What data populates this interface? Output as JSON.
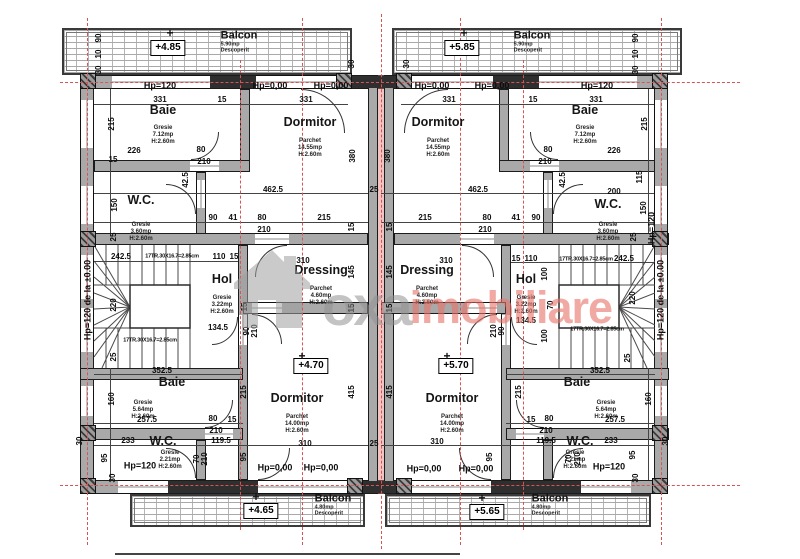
{
  "watermark": {
    "brand": "oxa",
    "suffix": "imobiliare"
  },
  "rooms": [
    {
      "id": "baie-top-left",
      "name": "Baie",
      "m": "Gresie",
      "a": "7.12mp",
      "h": "H:2.60m",
      "nx": 163,
      "ny": 110,
      "sx": 163,
      "sy": 125
    },
    {
      "id": "dormitor-top-left",
      "name": "Dormitor",
      "m": "Parchet",
      "a": "14.55mp",
      "h": "H:2.60m",
      "nx": 310,
      "ny": 122,
      "sx": 310,
      "sy": 138
    },
    {
      "id": "wc-top-left",
      "name": "W.C.",
      "m": "Gresie",
      "a": "3.60mp",
      "h": "H:2.60m",
      "nx": 141,
      "ny": 200,
      "sx": 141,
      "sy": 222
    },
    {
      "id": "hol-left",
      "name": "Hol",
      "m": "Gresie",
      "a": "3.22mp",
      "h": "H:2.60m",
      "nx": 222,
      "ny": 279,
      "sx": 222,
      "sy": 295
    },
    {
      "id": "dressing-left",
      "name": "Dressing",
      "m": "Parchet",
      "a": "4.60mp",
      "h": "H:2.60m",
      "nx": 321,
      "ny": 270,
      "sx": 321,
      "sy": 286
    },
    {
      "id": "dormitor-bottom-left",
      "name": "Dormitor",
      "m": "Parchet",
      "a": "14.00mp",
      "h": "H:2.60m",
      "nx": 297,
      "ny": 398,
      "sx": 297,
      "sy": 414
    },
    {
      "id": "baie-bottom-left",
      "name": "Baie",
      "m": "Gresie",
      "a": "5.64mp",
      "h": "H:2.60m",
      "nx": 172,
      "ny": 382,
      "sx": 143,
      "sy": 400
    },
    {
      "id": "wc-bottom-left",
      "name": "W.C.",
      "m": "Gresie",
      "a": "2.21mp",
      "h": "H:2.60m",
      "nx": 163,
      "ny": 441,
      "sx": 170,
      "sy": 450
    },
    {
      "id": "dormitor-top-right",
      "name": "Dormitor",
      "m": "Parchet",
      "a": "14.55mp",
      "h": "H:2.60m",
      "nx": 438,
      "ny": 122,
      "sx": 438,
      "sy": 138
    },
    {
      "id": "baie-top-right",
      "name": "Baie",
      "m": "Gresie",
      "a": "7.12mp",
      "h": "H:2.60m",
      "nx": 585,
      "ny": 110,
      "sx": 585,
      "sy": 125
    },
    {
      "id": "wc-top-right",
      "name": "W.C.",
      "m": "Gresie",
      "a": "3.60mp",
      "h": "H:2.60m",
      "nx": 608,
      "ny": 204,
      "sx": 608,
      "sy": 222
    },
    {
      "id": "hol-right",
      "name": "Hol",
      "m": "Gresie",
      "a": "3.22mp",
      "h": "H:2.60m",
      "nx": 526,
      "ny": 279,
      "sx": 526,
      "sy": 295
    },
    {
      "id": "dressing-right",
      "name": "Dressing",
      "m": "Parchet",
      "a": "4.60mp",
      "h": "H:2.60m",
      "nx": 427,
      "ny": 270,
      "sx": 427,
      "sy": 286
    },
    {
      "id": "dormitor-bottom-right",
      "name": "Dormitor",
      "m": "Parchet",
      "a": "14.00mp",
      "h": "H:2.60m",
      "nx": 452,
      "ny": 398,
      "sx": 452,
      "sy": 414
    },
    {
      "id": "baie-bottom-right",
      "name": "Baie",
      "m": "Gresie",
      "a": "5.64mp",
      "h": "H:2.60m",
      "nx": 577,
      "ny": 382,
      "sx": 606,
      "sy": 400
    },
    {
      "id": "wc-bottom-right",
      "name": "W.C.",
      "m": "Gresie",
      "a": "2.21mp",
      "h": "H:2.60m",
      "nx": 580,
      "ny": 441,
      "sx": 575,
      "sy": 450
    }
  ],
  "balconies": [
    {
      "id": "balcon-top-left",
      "label": "Balcon",
      "area": "5.90mp",
      "note": "Descoperit",
      "lx": 239,
      "ly": 42,
      "level": "+4.85",
      "vx": 168,
      "vy": 48,
      "cx": 170,
      "cy": 33
    },
    {
      "id": "balcon-top-right",
      "label": "Balcon",
      "area": "5.90mp",
      "note": "Descoperit",
      "lx": 532,
      "ly": 42,
      "level": "+5.85",
      "vx": 462,
      "vy": 48,
      "cx": 464,
      "cy": 33
    },
    {
      "id": "balcon-bottom-left",
      "label": "Balcon",
      "area": "4.80mp",
      "note": "Descoperit",
      "lx": 333,
      "ly": 505,
      "level": "+4.65",
      "vx": 261,
      "vy": 511,
      "cx": 256,
      "cy": 497
    },
    {
      "id": "balcon-bottom-right",
      "label": "Balcon",
      "area": "4.80mp",
      "note": "Descoperit",
      "lx": 550,
      "ly": 505,
      "level": "+5.65",
      "vx": 487,
      "vy": 512,
      "cx": 482,
      "cy": 498
    }
  ],
  "levels": [
    {
      "text": "+4.70",
      "x": 311,
      "y": 366,
      "cx": 302,
      "cy": 356
    },
    {
      "text": "+5.70",
      "x": 456,
      "y": 366,
      "cx": 447,
      "cy": 356
    }
  ],
  "dims": [
    {
      "t": "Hp=120",
      "x": 160,
      "y": 86,
      "c": "hp"
    },
    {
      "t": "Hp=0,00",
      "x": 270,
      "y": 86,
      "c": "hp"
    },
    {
      "t": "Hp=0,00",
      "x": 331,
      "y": 86,
      "c": "hp"
    },
    {
      "t": "Hp=0,00",
      "x": 432,
      "y": 86,
      "c": "hp"
    },
    {
      "t": "Hp=0,00",
      "x": 492,
      "y": 86,
      "c": "hp"
    },
    {
      "t": "Hp=120",
      "x": 597,
      "y": 86,
      "c": "hp"
    },
    {
      "t": "331",
      "x": 160,
      "y": 100
    },
    {
      "t": "15",
      "x": 222,
      "y": 100
    },
    {
      "t": "331",
      "x": 306,
      "y": 100
    },
    {
      "t": "331",
      "x": 449,
      "y": 100
    },
    {
      "t": "15",
      "x": 533,
      "y": 100
    },
    {
      "t": "331",
      "x": 596,
      "y": 100
    },
    {
      "t": "90",
      "x": 99,
      "y": 38,
      "r": 1
    },
    {
      "t": "10",
      "x": 99,
      "y": 54,
      "r": 1
    },
    {
      "t": "30",
      "x": 99,
      "y": 70,
      "r": 1
    },
    {
      "t": "90",
      "x": 636,
      "y": 38,
      "r": 1
    },
    {
      "t": "10",
      "x": 636,
      "y": 54,
      "r": 1
    },
    {
      "t": "30",
      "x": 636,
      "y": 70,
      "r": 1
    },
    {
      "t": "30",
      "x": 352,
      "y": 64,
      "r": 1
    },
    {
      "t": "30",
      "x": 407,
      "y": 64,
      "r": 1
    },
    {
      "t": "215",
      "x": 112,
      "y": 124,
      "r": 1
    },
    {
      "t": "226",
      "x": 134,
      "y": 151
    },
    {
      "t": "80",
      "x": 201,
      "y": 150
    },
    {
      "t": "210",
      "x": 204,
      "y": 162
    },
    {
      "t": "15",
      "x": 113,
      "y": 160
    },
    {
      "t": "150",
      "x": 115,
      "y": 205,
      "r": 1
    },
    {
      "t": "42.5",
      "x": 186,
      "y": 180,
      "r": 1
    },
    {
      "t": "462.5",
      "x": 273,
      "y": 190
    },
    {
      "t": "25",
      "x": 374,
      "y": 190
    },
    {
      "t": "462.5",
      "x": 478,
      "y": 190
    },
    {
      "t": "380",
      "x": 353,
      "y": 156,
      "r": 1
    },
    {
      "t": "380",
      "x": 388,
      "y": 156,
      "r": 1
    },
    {
      "t": "90",
      "x": 213,
      "y": 218
    },
    {
      "t": "41",
      "x": 233,
      "y": 218
    },
    {
      "t": "80",
      "x": 262,
      "y": 218
    },
    {
      "t": "215",
      "x": 324,
      "y": 218
    },
    {
      "t": "210",
      "x": 264,
      "y": 230
    },
    {
      "t": "15",
      "x": 352,
      "y": 227,
      "r": 1
    },
    {
      "t": "15",
      "x": 390,
      "y": 227,
      "r": 1
    },
    {
      "t": "215",
      "x": 425,
      "y": 218
    },
    {
      "t": "80",
      "x": 487,
      "y": 218
    },
    {
      "t": "41",
      "x": 516,
      "y": 218
    },
    {
      "t": "90",
      "x": 536,
      "y": 218
    },
    {
      "t": "210",
      "x": 485,
      "y": 230
    },
    {
      "t": "215",
      "x": 645,
      "y": 124,
      "r": 1
    },
    {
      "t": "226",
      "x": 614,
      "y": 151
    },
    {
      "t": "80",
      "x": 548,
      "y": 150
    },
    {
      "t": "210",
      "x": 545,
      "y": 162
    },
    {
      "t": "200",
      "x": 614,
      "y": 192
    },
    {
      "t": "115",
      "x": 640,
      "y": 177,
      "r": 1
    },
    {
      "t": "150",
      "x": 644,
      "y": 208,
      "r": 1
    },
    {
      "t": "42.5",
      "x": 563,
      "y": 180,
      "r": 1
    },
    {
      "t": "Hp=120",
      "x": 652,
      "y": 228,
      "r": 1,
      "c": "hp"
    },
    {
      "t": "242.5",
      "x": 121,
      "y": 257
    },
    {
      "t": "17TR.30X16.7=2.85cm",
      "x": 172,
      "y": 257,
      "c": "tn"
    },
    {
      "t": "110",
      "x": 219,
      "y": 257
    },
    {
      "t": "15",
      "x": 234,
      "y": 257
    },
    {
      "t": "15",
      "x": 516,
      "y": 259
    },
    {
      "t": "110",
      "x": 531,
      "y": 259
    },
    {
      "t": "17TR.30X16.7=2.85cm",
      "x": 586,
      "y": 260,
      "c": "tn"
    },
    {
      "t": "242.5",
      "x": 624,
      "y": 259
    },
    {
      "t": "17TR.30X16.7=2.85cm",
      "x": 150,
      "y": 341,
      "c": "tn"
    },
    {
      "t": "17TR.30X16.7=2.85cm",
      "x": 597,
      "y": 330,
      "c": "tn"
    },
    {
      "t": "Hp=120 de la ±0.00",
      "x": 88,
      "y": 300,
      "r": 1,
      "c": "hp"
    },
    {
      "t": "Hp=120 de la ±0.00",
      "x": 661,
      "y": 300,
      "r": 1,
      "c": "hp"
    },
    {
      "t": "220",
      "x": 114,
      "y": 305,
      "r": 1
    },
    {
      "t": "220",
      "x": 633,
      "y": 298,
      "r": 1
    },
    {
      "t": "100",
      "x": 545,
      "y": 274,
      "r": 1
    },
    {
      "t": "70",
      "x": 551,
      "y": 305,
      "r": 1
    },
    {
      "t": "100",
      "x": 545,
      "y": 336,
      "r": 1
    },
    {
      "t": "134.5",
      "x": 218,
      "y": 328
    },
    {
      "t": "134.5",
      "x": 526,
      "y": 321
    },
    {
      "t": "25",
      "x": 114,
      "y": 237,
      "r": 1
    },
    {
      "t": "25",
      "x": 634,
      "y": 237,
      "r": 1
    },
    {
      "t": "25",
      "x": 114,
      "y": 357,
      "r": 1
    },
    {
      "t": "25",
      "x": 628,
      "y": 358,
      "r": 1
    },
    {
      "t": "310",
      "x": 303,
      "y": 261
    },
    {
      "t": "310",
      "x": 446,
      "y": 261
    },
    {
      "t": "145",
      "x": 352,
      "y": 272,
      "r": 1
    },
    {
      "t": "145",
      "x": 390,
      "y": 272,
      "r": 1
    },
    {
      "t": "15",
      "x": 352,
      "y": 308,
      "r": 1
    },
    {
      "t": "15",
      "x": 390,
      "y": 308,
      "r": 1
    },
    {
      "t": "15",
      "x": 245,
      "y": 307,
      "r": 1
    },
    {
      "t": "90",
      "x": 247,
      "y": 331,
      "r": 1
    },
    {
      "t": "210",
      "x": 255,
      "y": 331,
      "r": 1
    },
    {
      "t": "90",
      "x": 502,
      "y": 331,
      "r": 1
    },
    {
      "t": "210",
      "x": 494,
      "y": 331,
      "r": 1
    },
    {
      "t": "215",
      "x": 244,
      "y": 392,
      "r": 1
    },
    {
      "t": "160",
      "x": 112,
      "y": 399,
      "r": 1
    },
    {
      "t": "415",
      "x": 352,
      "y": 392,
      "r": 1
    },
    {
      "t": "415",
      "x": 390,
      "y": 392,
      "r": 1
    },
    {
      "t": "160",
      "x": 649,
      "y": 399,
      "r": 1
    },
    {
      "t": "215",
      "x": 519,
      "y": 392,
      "r": 1
    },
    {
      "t": "352.5",
      "x": 162,
      "y": 371
    },
    {
      "t": "352.5",
      "x": 600,
      "y": 371
    },
    {
      "t": "257.5",
      "x": 147,
      "y": 420
    },
    {
      "t": "257.5",
      "x": 615,
      "y": 420
    },
    {
      "t": "80",
      "x": 213,
      "y": 419
    },
    {
      "t": "210",
      "x": 216,
      "y": 431
    },
    {
      "t": "15",
      "x": 232,
      "y": 420
    },
    {
      "t": "80",
      "x": 549,
      "y": 419
    },
    {
      "t": "210",
      "x": 546,
      "y": 431
    },
    {
      "t": "15",
      "x": 531,
      "y": 420
    },
    {
      "t": "310",
      "x": 305,
      "y": 444
    },
    {
      "t": "25",
      "x": 374,
      "y": 444
    },
    {
      "t": "310",
      "x": 437,
      "y": 442
    },
    {
      "t": "233",
      "x": 128,
      "y": 441
    },
    {
      "t": "119.5",
      "x": 221,
      "y": 441
    },
    {
      "t": "119.5",
      "x": 546,
      "y": 441
    },
    {
      "t": "233",
      "x": 611,
      "y": 441
    },
    {
      "t": "95",
      "x": 244,
      "y": 457,
      "r": 1
    },
    {
      "t": "95",
      "x": 105,
      "y": 458,
      "r": 1
    },
    {
      "t": "95",
      "x": 490,
      "y": 457,
      "r": 1
    },
    {
      "t": "95",
      "x": 633,
      "y": 455,
      "r": 1
    },
    {
      "t": "70",
      "x": 197,
      "y": 459,
      "r": 1
    },
    {
      "t": "210",
      "x": 205,
      "y": 459,
      "r": 1
    },
    {
      "t": "70",
      "x": 569,
      "y": 459,
      "r": 1
    },
    {
      "t": "210",
      "x": 578,
      "y": 459,
      "r": 1
    },
    {
      "t": "Hp=120",
      "x": 140,
      "y": 466,
      "c": "hp"
    },
    {
      "t": "Hp=120",
      "x": 609,
      "y": 467,
      "c": "hp"
    },
    {
      "t": "Hp=0,00",
      "x": 275,
      "y": 468,
      "c": "hp"
    },
    {
      "t": "Hp=0,00",
      "x": 321,
      "y": 468,
      "c": "hp"
    },
    {
      "t": "Hp=0,00",
      "x": 424,
      "y": 469,
      "c": "hp"
    },
    {
      "t": "Hp=0,00",
      "x": 476,
      "y": 469,
      "c": "hp"
    },
    {
      "t": "30",
      "x": 80,
      "y": 441,
      "r": 1
    },
    {
      "t": "30",
      "x": 113,
      "y": 478,
      "r": 1
    },
    {
      "t": "30",
      "x": 666,
      "y": 441,
      "r": 1
    },
    {
      "t": "30",
      "x": 636,
      "y": 478,
      "r": 1
    }
  ]
}
